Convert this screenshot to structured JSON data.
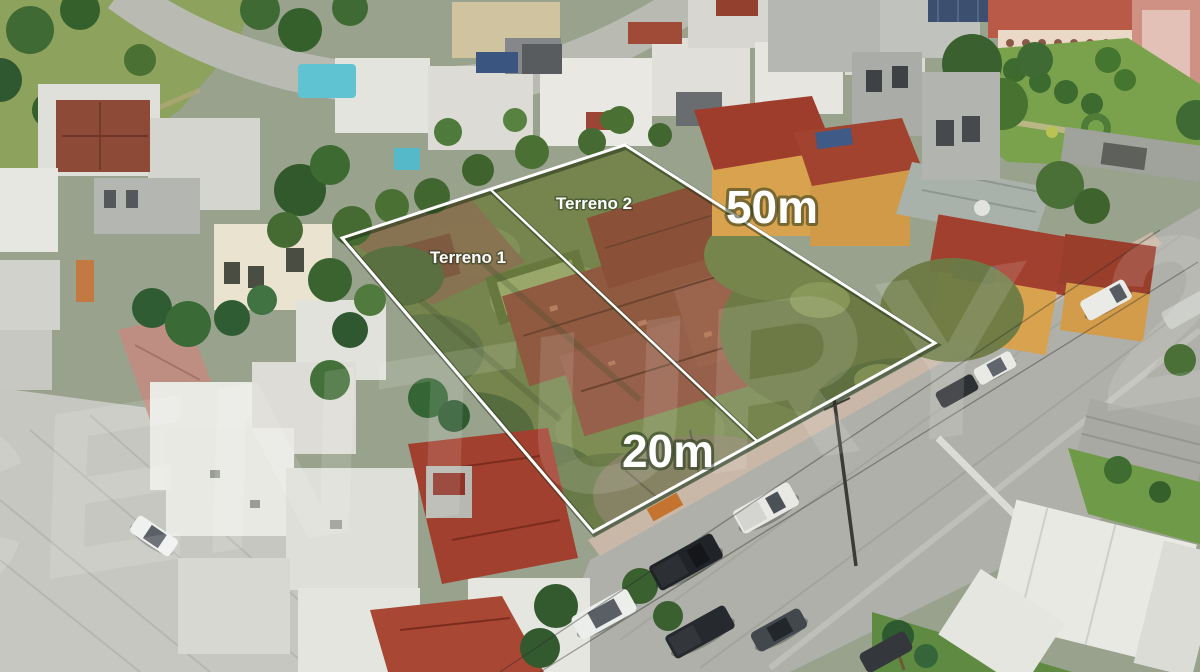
{
  "photo": {
    "kind": "aerial drone photograph",
    "subject": "Two adjacent vacant lots outlined in white inside a residential neighborhood with streets, parked cars, tile-roof houses and a large garden courtyard",
    "palette": {
      "vacant_lot_green": "#76854e",
      "old_tile_roof_brown": "#96604a",
      "red_tile_roof": "#a2402f",
      "orange_house_wall": "#d8a24e",
      "white_rooftop": "#e9e9e4",
      "concrete_street": "#c6c7c0",
      "asphalt_street": "#aeb0a9",
      "sidewalk": "#c9b7a8",
      "pool_water": "#9aa76a",
      "garden_lawn": "#7aa24c"
    }
  },
  "annotations": {
    "lot1_label": "Terreno 1",
    "lot2_label": "Terreno 2",
    "side_dimension": "50m",
    "front_dimension": "20m",
    "line_color": "#ffffff",
    "label_color": "#ffffff"
  },
  "watermark": {
    "text": "CENTURY 21",
    "color": "#ffffff"
  }
}
